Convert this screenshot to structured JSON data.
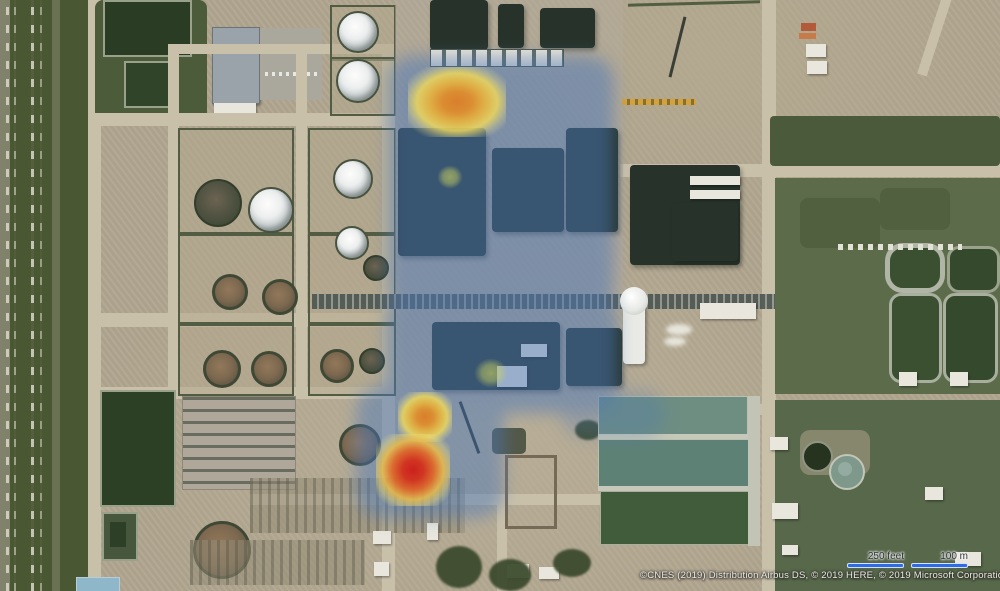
{
  "map": {
    "view": "aerial-satellite",
    "subject": "industrial-plant-with-emission-heatmap",
    "attribution": "©CNES (2019) Distribution Airbus DS, © 2019 HERE, © 2019 Microsoft Corporation",
    "scale_bar": {
      "feet": "250 feet",
      "meters": "100 m",
      "bar_color": "#2e6be6"
    }
  },
  "heatmap": {
    "field_color": "#4a77b8",
    "levels": {
      "low": "#ccd45f",
      "medium": "#e0892a",
      "high": "#d32020"
    },
    "body": [
      {
        "x": 388,
        "y": 56,
        "w": 226,
        "h": 254
      },
      {
        "x": 386,
        "y": 293,
        "w": 232,
        "h": 120
      },
      {
        "x": 356,
        "y": 386,
        "w": 148,
        "h": 132,
        "o": 0.95
      },
      {
        "x": 560,
        "y": 390,
        "w": 105,
        "h": 48,
        "o": 0.55
      }
    ],
    "hotspots": [
      {
        "x": 457,
        "y": 102,
        "rx": 49,
        "ry": 35,
        "level": "medium"
      },
      {
        "x": 450,
        "y": 177,
        "rx": 13,
        "ry": 12,
        "level": "low"
      },
      {
        "x": 491,
        "y": 373,
        "rx": 17,
        "ry": 15,
        "level": "low"
      },
      {
        "x": 425,
        "y": 417,
        "rx": 27,
        "ry": 25,
        "level": "medium"
      },
      {
        "x": 413,
        "y": 470,
        "rx": 37,
        "ry": 36,
        "level": "high"
      }
    ]
  }
}
